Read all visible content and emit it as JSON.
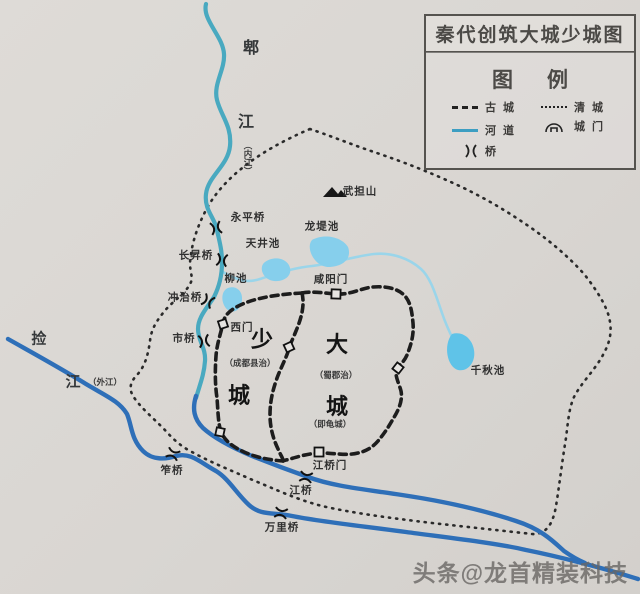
{
  "title": "秦代创筑大城少城图",
  "legend": {
    "heading": "图例",
    "items": [
      {
        "symbol": "dashed-line",
        "label": "古城"
      },
      {
        "symbol": "dotted-line",
        "label": "清城"
      },
      {
        "symbol": "river-line",
        "label": "河道"
      },
      {
        "symbol": "gate-arch",
        "label": "城门"
      },
      {
        "symbol": "bridge-marks",
        "label": "桥"
      }
    ]
  },
  "rivers": {
    "pi_jiang": {
      "char1": "郫",
      "char2": "江",
      "alias": "（内江）"
    },
    "jian_jiang": {
      "char1": "捡",
      "char2": "江",
      "alias": "（外江）"
    }
  },
  "cities": {
    "shao_cheng": {
      "char1": "少",
      "char2": "城",
      "seat": "（成都县治）"
    },
    "da_cheng": {
      "char1": "大",
      "char2": "城",
      "seat": "（蜀郡治）",
      "alias": "（即龟城）"
    }
  },
  "gates": {
    "west": "西门",
    "xianyang": "咸阳门",
    "jiangqiao": "江桥门"
  },
  "bridges": {
    "yongping": "永平桥",
    "changsheng": "长昇桥",
    "chongzhi": "冲治桥",
    "shi": "市桥",
    "zuo": "笮桥",
    "jiang": "江桥",
    "wanli": "万里桥"
  },
  "ponds": {
    "longdi": "龙堤池",
    "tianjing": "天井池",
    "liu": "柳池",
    "qianqiu": "千秋池"
  },
  "mountain": "武担山",
  "watermark": "头条@龙首精装科技",
  "colors": {
    "river_upper": "#49a9c0",
    "river_lower": "#2e6fb8",
    "pond": "#86cfec",
    "wall": "#1d1d1d",
    "qing_outline": "#2a2a2a",
    "text": "#2e2e2e"
  }
}
